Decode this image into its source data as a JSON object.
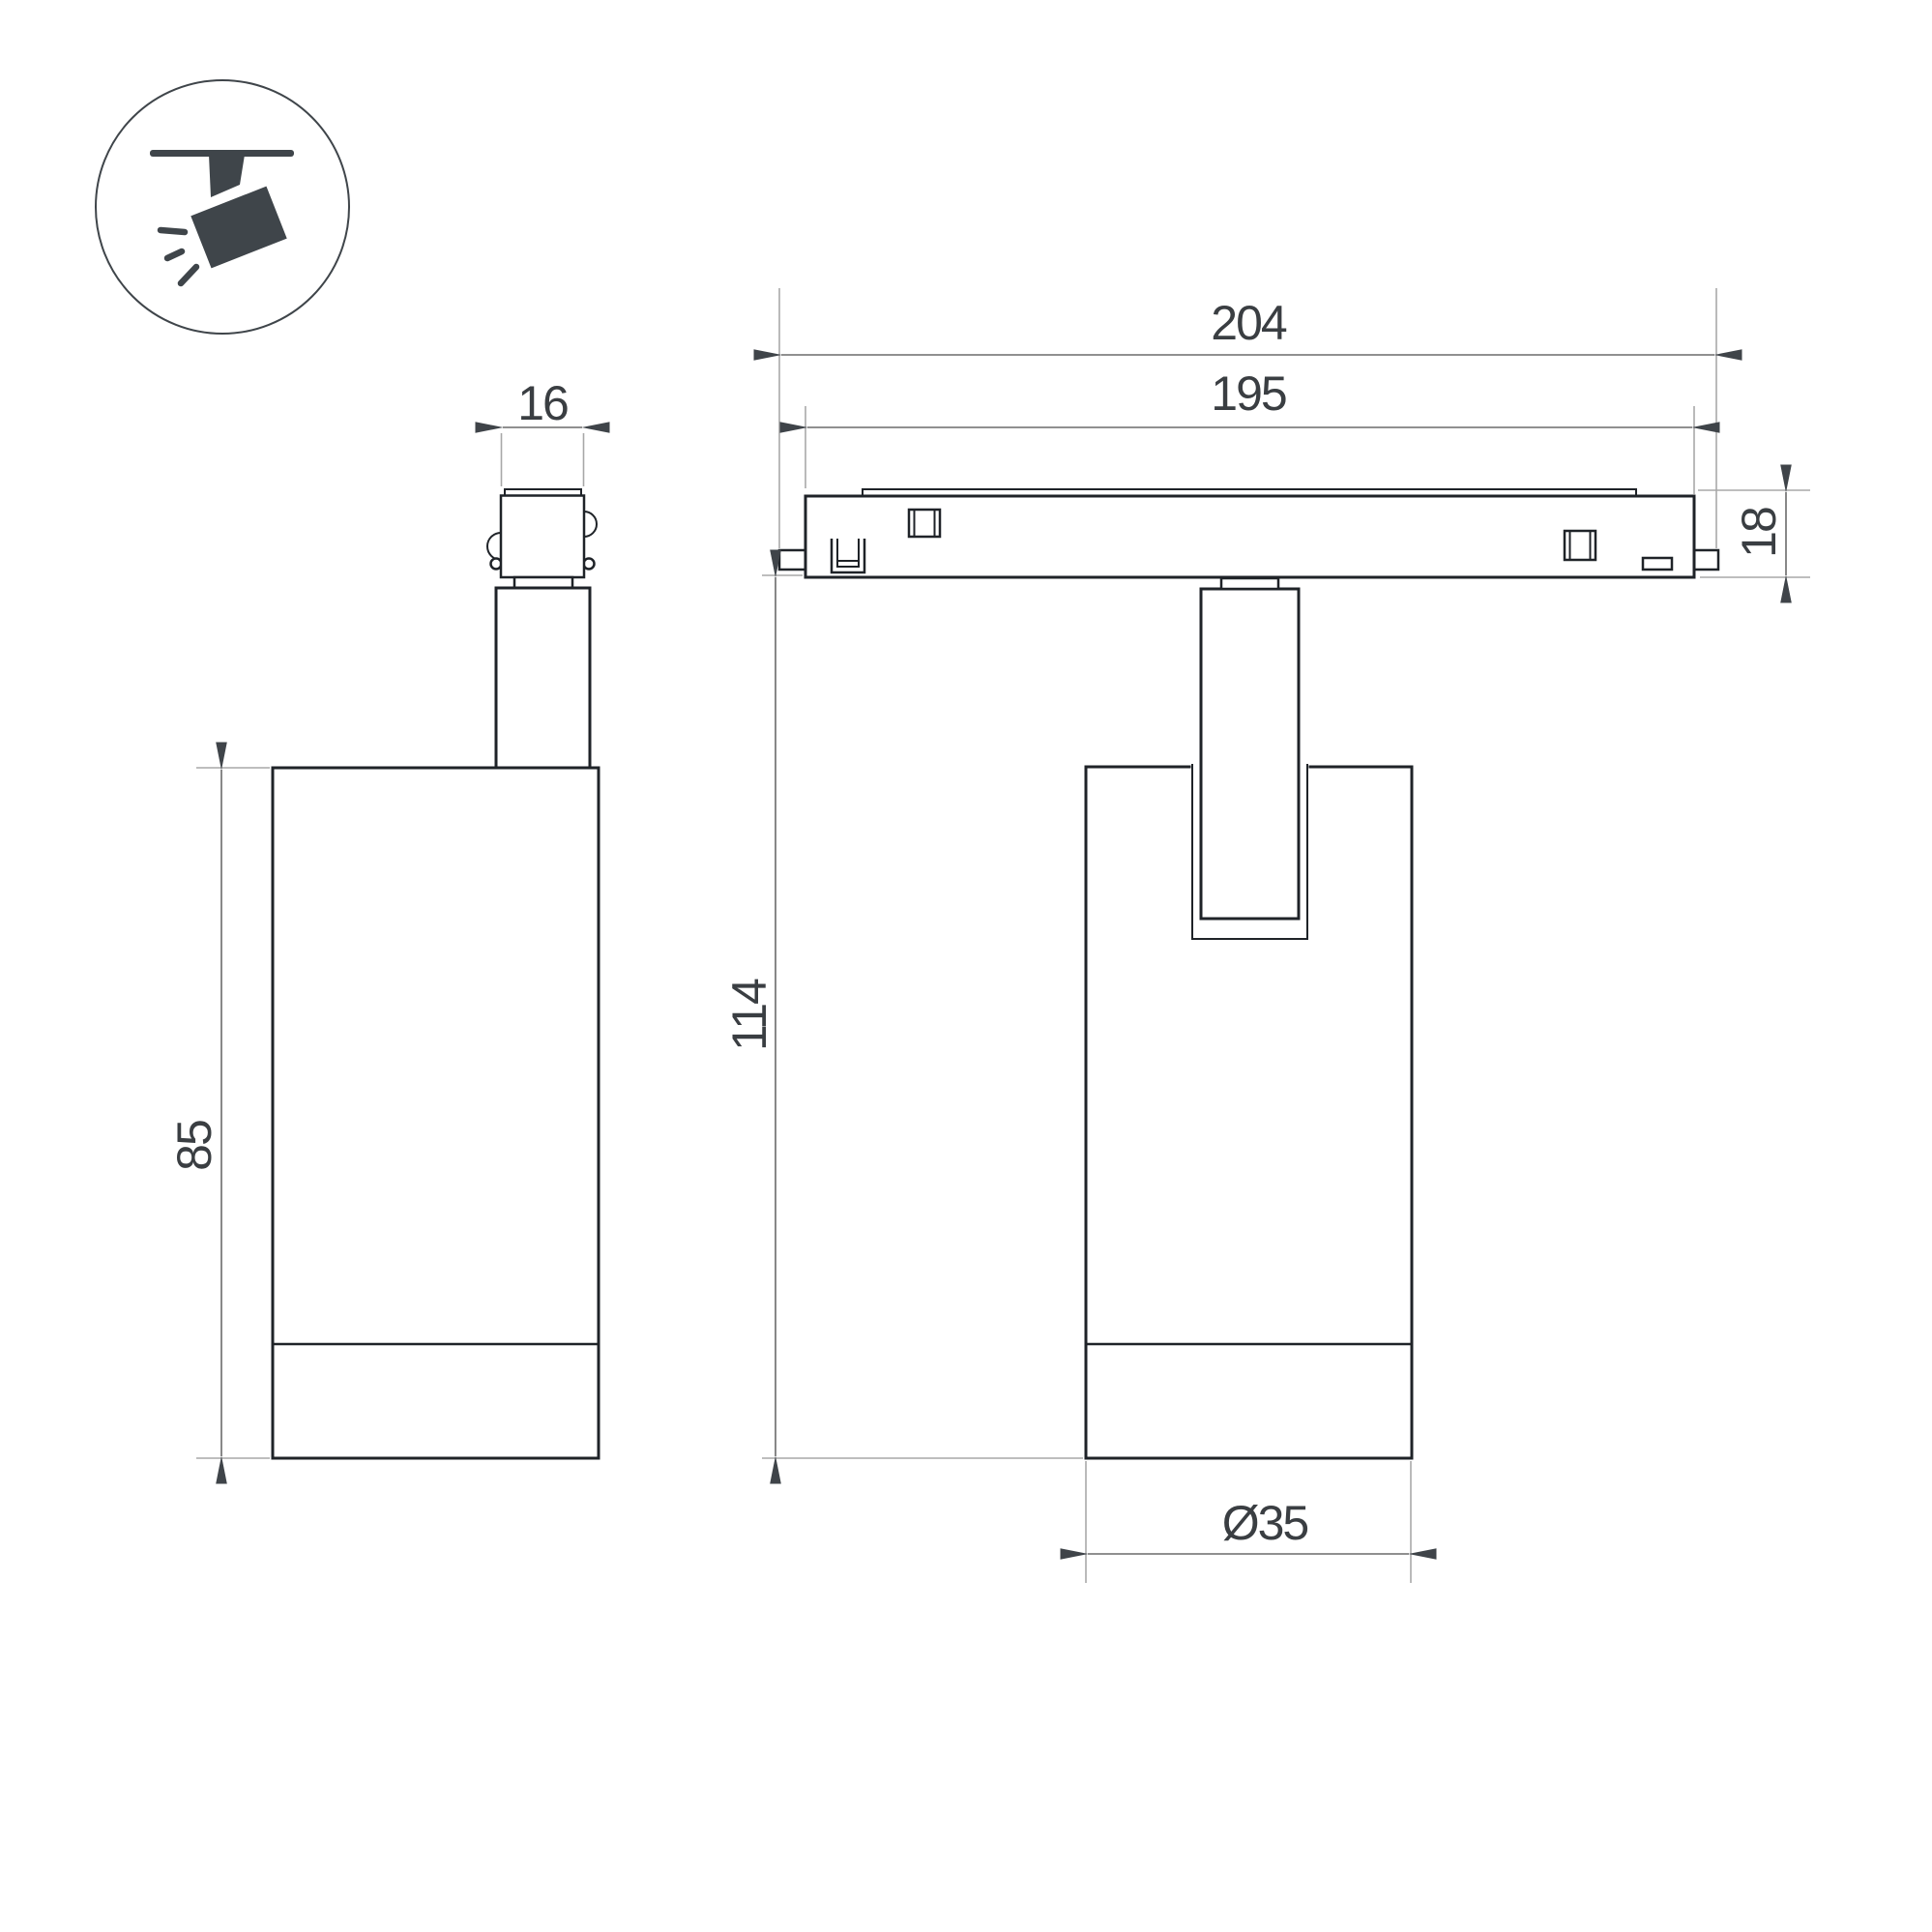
{
  "drawing": {
    "type": "technical-dimension-drawing",
    "subject": "magnetic-track-spotlight",
    "background": "#ffffff"
  },
  "icon_legend": {
    "name": "ceiling-track-spotlight-icon",
    "color": "#3f454a",
    "circle_stroke": "#3f454a"
  },
  "colors": {
    "outline": "#1f2328",
    "dimension_line": "#6b6b6b",
    "extension_line": "#a8a8a8",
    "arrowhead": "#3f4449",
    "text": "#3a3e42"
  },
  "dimensions": {
    "adapter_width": {
      "value": "16",
      "orientation": "horizontal"
    },
    "overall_length": {
      "value": "204",
      "orientation": "horizontal"
    },
    "rail_length": {
      "value": "195",
      "orientation": "horizontal"
    },
    "rail_height": {
      "value": "18",
      "orientation": "vertical"
    },
    "body_height": {
      "value": "85",
      "orientation": "vertical"
    },
    "total_height": {
      "value": "114",
      "orientation": "vertical"
    },
    "body_diameter": {
      "value": "Ø35",
      "orientation": "horizontal"
    }
  }
}
